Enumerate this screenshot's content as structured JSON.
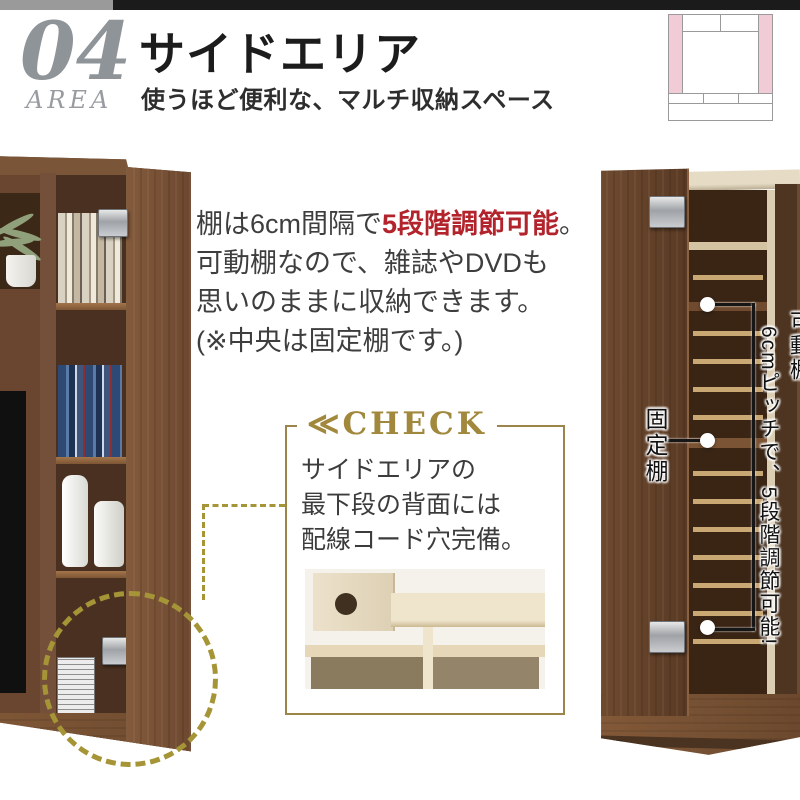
{
  "header": {
    "number": "04",
    "area_label": "AREA",
    "title": "サイドエリア",
    "subtitle": "使うほど便利な、マルチ収納スペース"
  },
  "layout_diagram": {
    "meaning": "tv-board front elevation, side storage columns highlighted",
    "highlight_color": "#f1ccd7",
    "line_color": "#9a9a9a"
  },
  "main_text": {
    "line1_pre": "棚は6cm間隔で",
    "line1_highlight": "5段階調節可能",
    "line1_post": "。",
    "line2": "可動棚なので、雑誌やDVDも",
    "line3": "思いのままに収納できます。",
    "line4": "(※中央は固定棚です。)",
    "text_color": "#3e3e3e",
    "highlight_color": "#b2232c"
  },
  "check_box": {
    "title": "≪CHECK",
    "line1": "サイドエリアの",
    "line2": "最下段の背面には",
    "line3": "配線コード穴完備。",
    "accent_color": "#a1883d",
    "border_color": "#9c854a"
  },
  "connector": {
    "color": "#a59537",
    "style": "dashed line and dashed circle around lower door hinge"
  },
  "right_photo_labels": {
    "fixed_shelf": "固定棚",
    "movable_shelf": "可動棚",
    "movable_detail": "6cmピッチで、5段階調節可能!"
  },
  "top_bar": {
    "gray": "#9a9a9a",
    "black": "#1b1b1b"
  }
}
